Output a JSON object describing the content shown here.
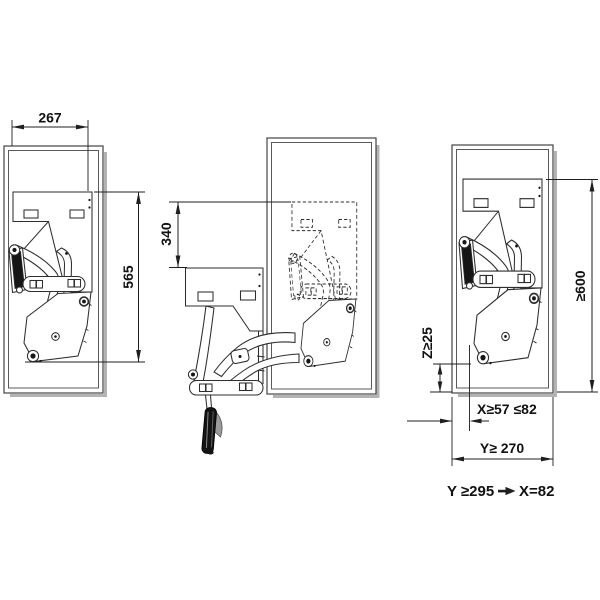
{
  "dims": {
    "width": "267",
    "height": "565",
    "travel": "340",
    "cabinet_height": "≥600",
    "bottom_clearance": "Z≥25",
    "front_distance": "X≥57 ≤82",
    "depth": "Y≥ 270"
  },
  "note": {
    "condition": "Y ≥295",
    "result": "X=82",
    "arrow_icon": "right-arrow-icon"
  },
  "colors": {
    "ink": "#2e2e2e",
    "dimension_ink": "#1f1f1f",
    "dark_fill": "#161616",
    "cabinet_shadow": "#b3b3b3",
    "paper": "#ffffff",
    "handle_flap": "#9a9a9a"
  }
}
